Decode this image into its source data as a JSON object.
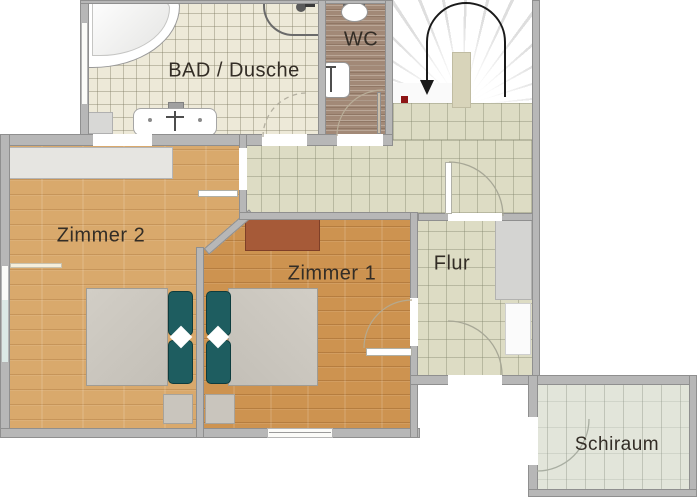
{
  "rooms": {
    "bad": {
      "label": "BAD / Dusche"
    },
    "wc": {
      "label": "WC"
    },
    "zimmer2": {
      "label": "Zimmer 2"
    },
    "zimmer1": {
      "label": "Zimmer 1"
    },
    "flur": {
      "label": "Flur"
    },
    "schiraum": {
      "label": "Schiraum"
    }
  },
  "stairs": {
    "direction_icon": "u-turn-down-arrow",
    "marker_color": "#8e1616"
  },
  "colors": {
    "wall": "#b7b7b7",
    "bath_tile": "#ede9d8",
    "wc_floor": "#a28977",
    "hall_tile": "#dddcc4",
    "wood_zimmer2": "#d9a96c",
    "wood_zimmer1": "#cd9350",
    "schiraum_floor": "#e2e5da",
    "pillow_teal": "#1e5d60",
    "mattress_gray": "#cbc7bf",
    "dresser_red": "#a65a38",
    "arrow_black": "#1a1a1a",
    "label_text": "#332d26"
  }
}
